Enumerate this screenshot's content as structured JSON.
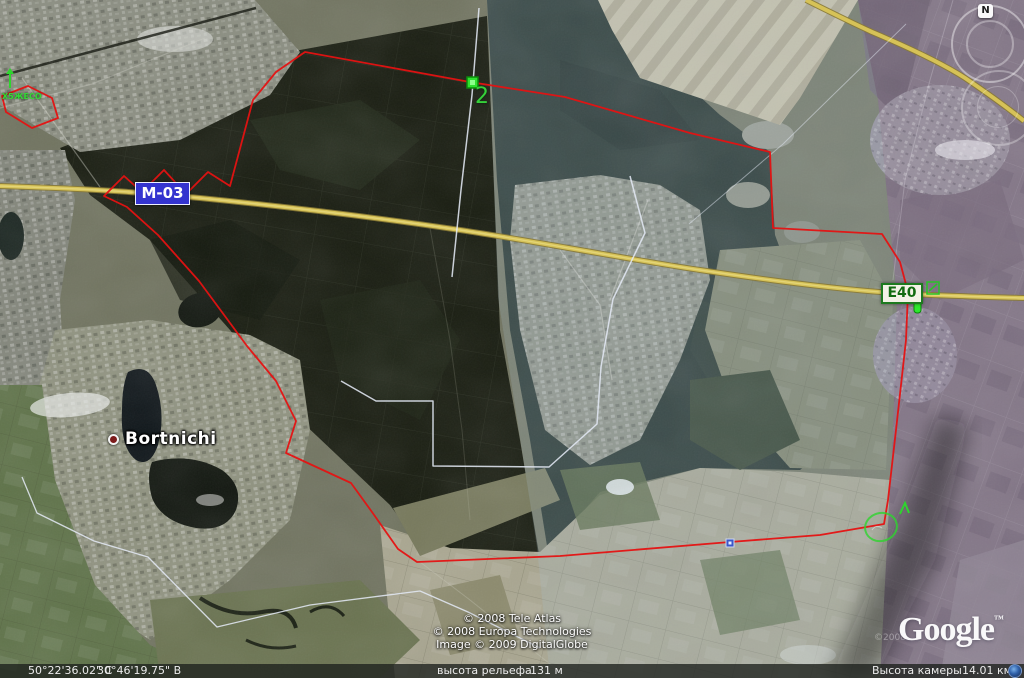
{
  "map": {
    "place_label": "Bortnichi",
    "road_badges": {
      "m03": "М-03",
      "e40": "Е40"
    },
    "green_markers": {
      "top_left_label": "Х5ЖЕСО",
      "marker2_label": "2"
    },
    "compass_n": "N"
  },
  "attribution": {
    "line1": "© 2008 Tele Atlas",
    "line2": "© 2008 Europa Technologies",
    "line3": "Image © 2009 DigitalGlobe",
    "faint_year": "©2008",
    "logo": "Google",
    "logo_tm": "™"
  },
  "status_bar": {
    "latitude": "50°22'36.02\" С",
    "longitude": "30°46'19.75\" В",
    "elevation_label": "высота рельефа",
    "elevation_value": "131 м",
    "camera_label": "Высота камеры",
    "camera_value": "14.01 км"
  },
  "colors": {
    "route_red": "#e51212",
    "highway_yellow": "#d6c257",
    "marker_green": "#2fe02f",
    "badge_blue": "#3434cf",
    "badge_green_border": "#1d7a1f",
    "boundary_white": "#e3e7f2"
  }
}
